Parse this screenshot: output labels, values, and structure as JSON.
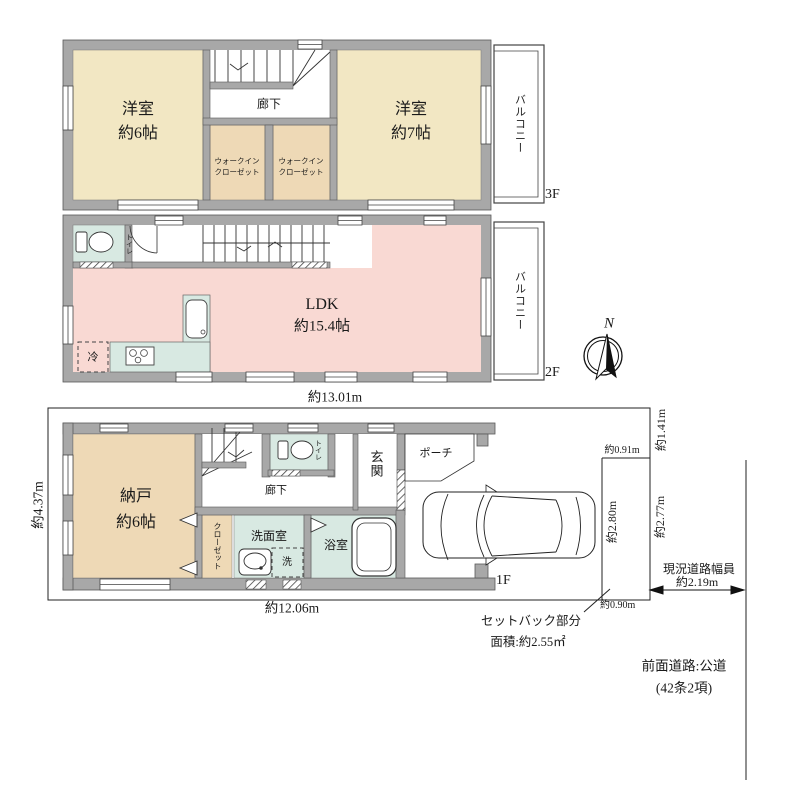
{
  "colors": {
    "wall": "#a8a8a8",
    "room_cream": "#f2e7c3",
    "room_tan": "#eed9b6",
    "room_pink": "#f9d9d3",
    "room_green": "#d8e9e2",
    "line": "#333333"
  },
  "compass": {
    "north": "N"
  },
  "floor3": {
    "label": "3F",
    "room_west_line1": "洋室",
    "room_west_line2": "約6帖",
    "hallway": "廊下",
    "wic_line1": "ウォークイン",
    "wic_line2": "クローゼット",
    "room_east_line1": "洋室",
    "room_east_line2": "約7帖",
    "balcony": "バルコニー"
  },
  "floor2": {
    "label": "2F",
    "toilet": "トイレ",
    "ldk_line1": "LDK",
    "ldk_line2": "約15.4帖",
    "fridge": "冷",
    "balcony": "バルコニー",
    "width_dim": "約13.01m"
  },
  "floor1": {
    "label": "1F",
    "storage_line1": "納戸",
    "storage_line2": "約6帖",
    "closet": "クローゼット",
    "toilet": "トイレ",
    "hallway": "廊下",
    "entrance": "玄関",
    "porch": "ポーチ",
    "washroom": "洗面室",
    "washer": "洗",
    "bathroom": "浴室",
    "width_dim": "約12.06m",
    "depth_dim": "約4.37m"
  },
  "site": {
    "dim_top_right": "約1.41m",
    "dim_setback_width_top": "約0.91m",
    "dim_setback_left": "約2.80m",
    "dim_setback_right": "約2.77m",
    "dim_setback_width_bottom": "約0.90m",
    "road_width_label": "現況道路幅員",
    "road_width_value": "約2.19m",
    "setback_line1": "セットバック部分",
    "setback_line2": "面積:約2.55㎡",
    "front_road_line1": "前面道路:公道",
    "front_road_line2": "(42条2項)"
  }
}
